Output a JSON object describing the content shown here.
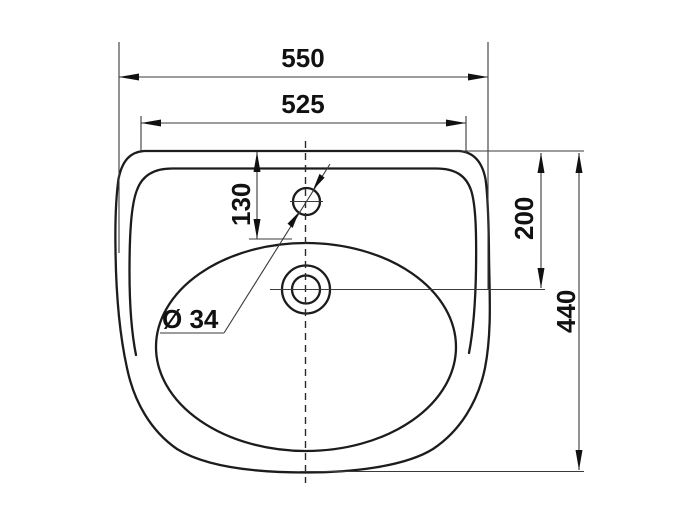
{
  "drawing": {
    "title": "washbasin top-view dimension drawing",
    "labels": {
      "dim_550": "550",
      "dim_525": "525",
      "dim_130": "130",
      "dim_200": "200",
      "dim_440": "440",
      "dim_diameter": "Ø 34"
    },
    "colors": {
      "line": "#1c1c1c",
      "dimension_line": "#3a3a3a",
      "background": "#ffffff"
    }
  }
}
